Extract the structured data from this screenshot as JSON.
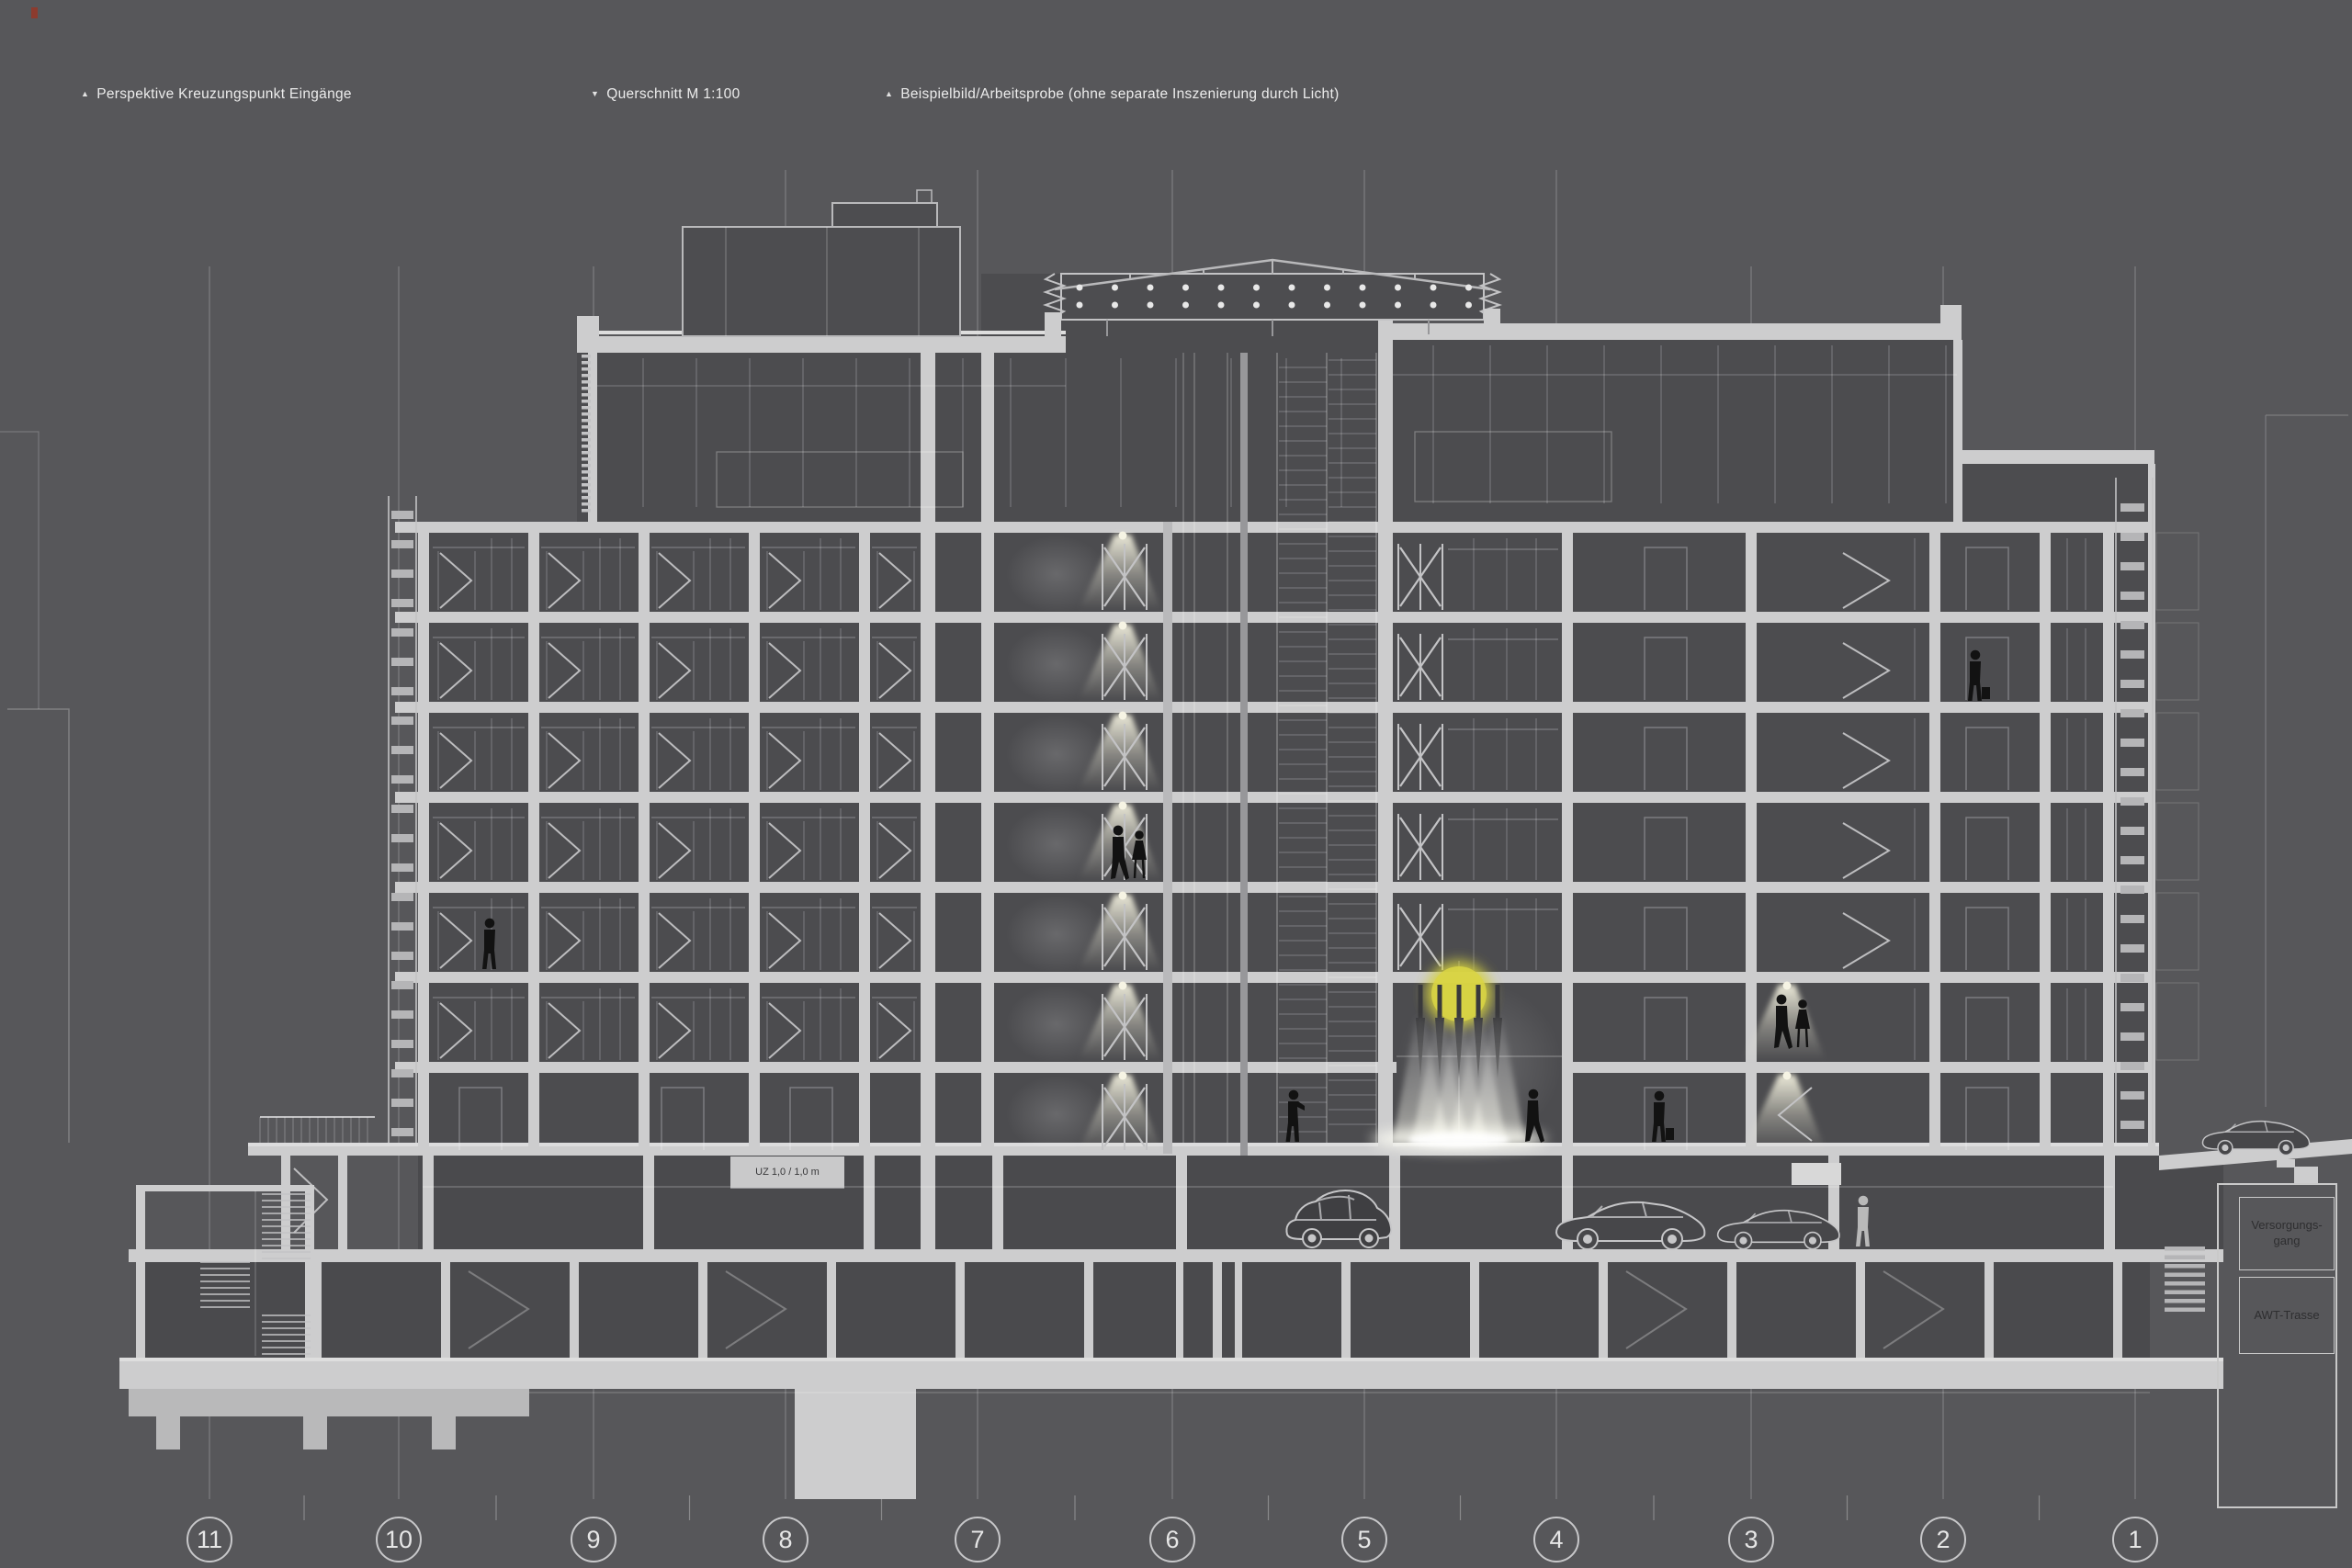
{
  "header": {
    "notes": [
      {
        "icon": "triangle-up-icon",
        "arrow": "▲",
        "text": "Perspektive Kreuzungspunkt Eingänge"
      },
      {
        "icon": "triangle-down-icon",
        "arrow": "▼",
        "text": "Querschnitt M 1:100"
      },
      {
        "icon": "triangle-up-icon",
        "arrow": "▲",
        "text": "Beispielbild/Arbeitsprobe (ohne separate Inszenierung durch Licht)"
      }
    ]
  },
  "axis": {
    "markers": [
      "11",
      "10",
      "9",
      "8",
      "7",
      "6",
      "5",
      "4",
      "3",
      "2",
      "1"
    ]
  },
  "labels": {
    "supply_corridor": "Versorgungs-\ngang",
    "awt_route": "AWT-Trasse",
    "beam_note": "UZ 1,0 / 1,0 m"
  },
  "colors": {
    "background": "#57575a",
    "structure": "#cdcdce",
    "linework": "#c3c3c5",
    "room_fill": "#4c4c4f",
    "light_glow": "#efeddc",
    "lamp_yellow": "#d6d23f",
    "silhouette": "#121212"
  }
}
